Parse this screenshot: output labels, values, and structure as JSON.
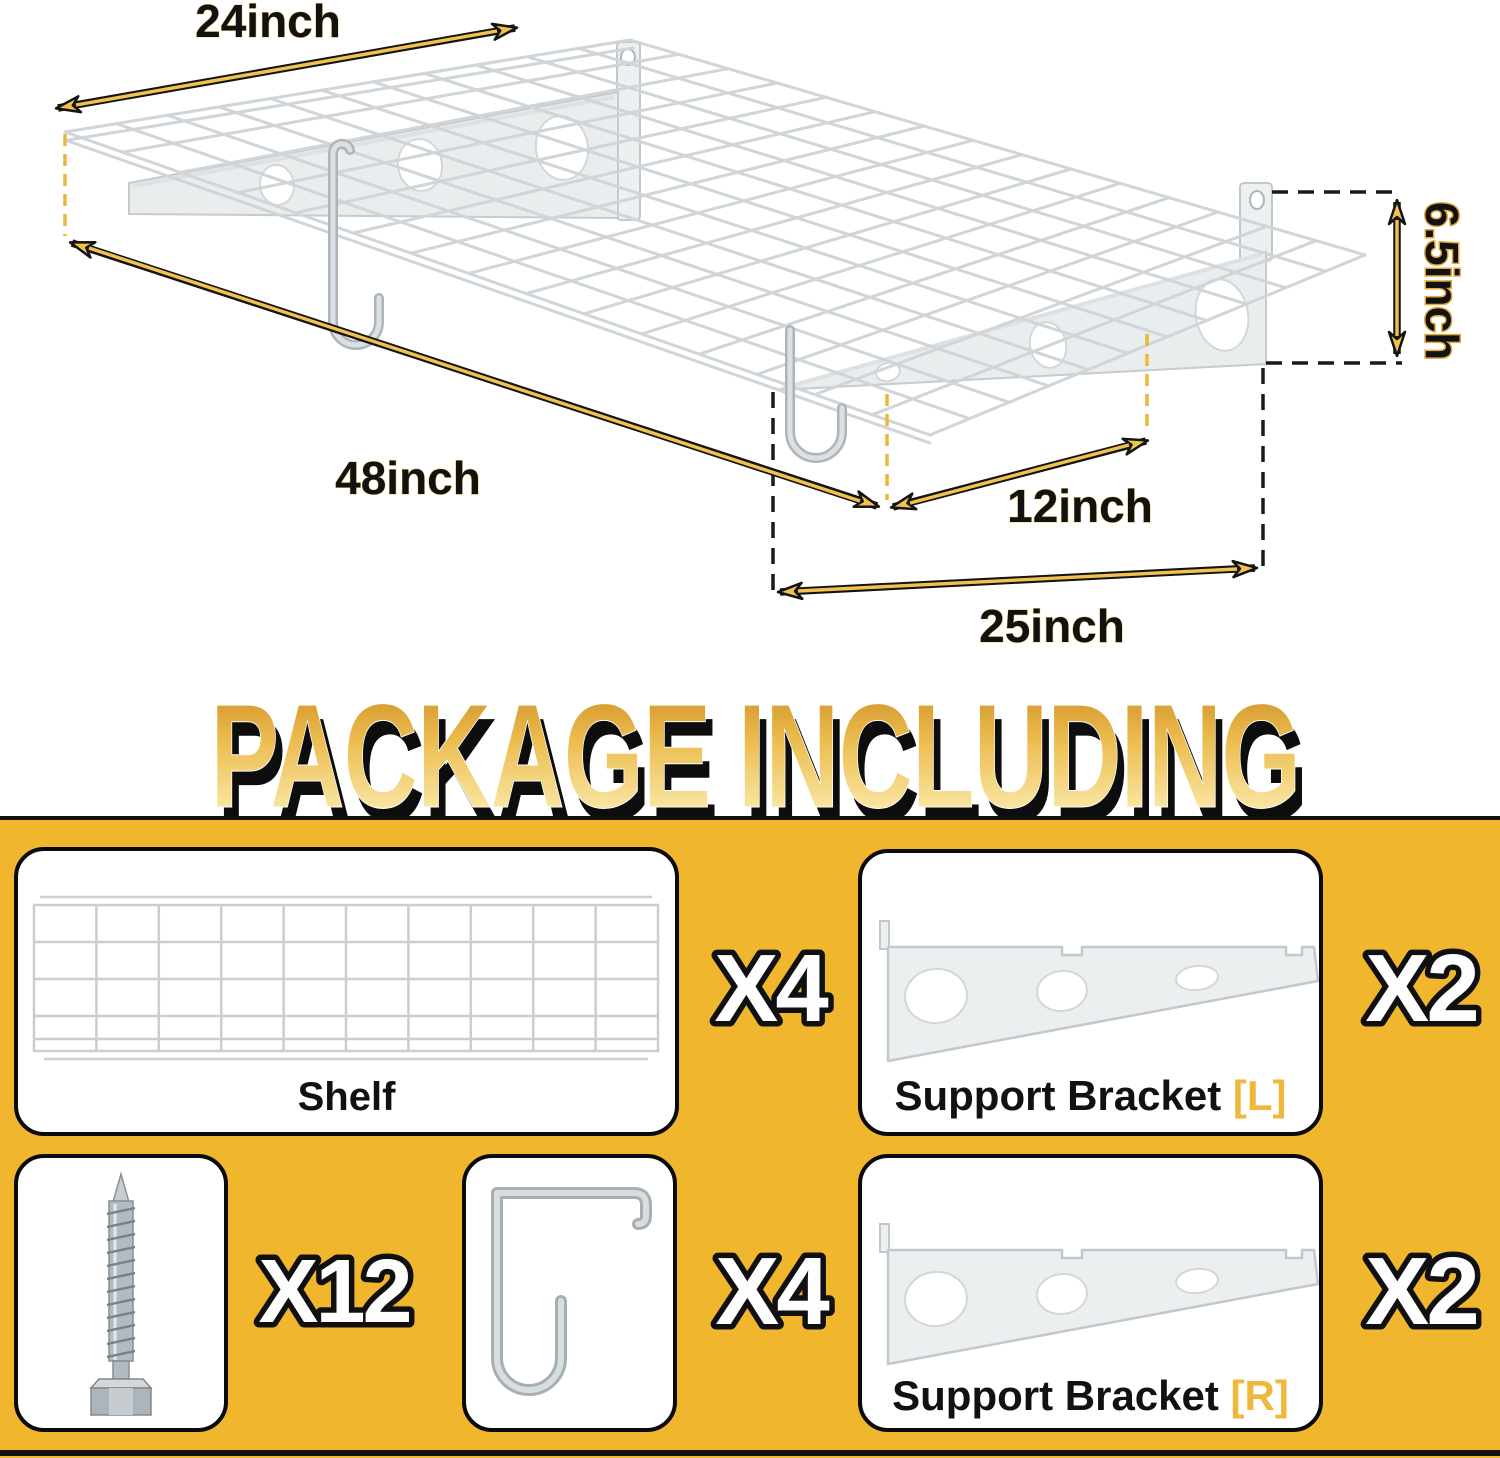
{
  "title": "PACKAGE INCLUDING",
  "diagram": {
    "dim_width": "24inch",
    "dim_length": "48inch",
    "dim_height": "6.5inch",
    "dim_bracket_depth": "12inch",
    "dim_bracket_span": "25inch"
  },
  "package": {
    "shelf": {
      "label": "Shelf",
      "qty": "X4"
    },
    "bracket_left": {
      "label": "Support Bracket ",
      "suffix": "[L]",
      "qty": "X2"
    },
    "screws": {
      "qty": "X12"
    },
    "hooks": {
      "qty": "X4"
    },
    "bracket_right": {
      "label": "Support Bracket ",
      "suffix": "[R]",
      "qty": "X2"
    }
  },
  "colors": {
    "background_yellow": "#F0B72E",
    "suffix_gold": "#EFB73B",
    "arrow_yellow": "#F2C24E",
    "title_gradient_top": "#C9871C",
    "title_gradient_bottom": "#FDF2C6"
  }
}
